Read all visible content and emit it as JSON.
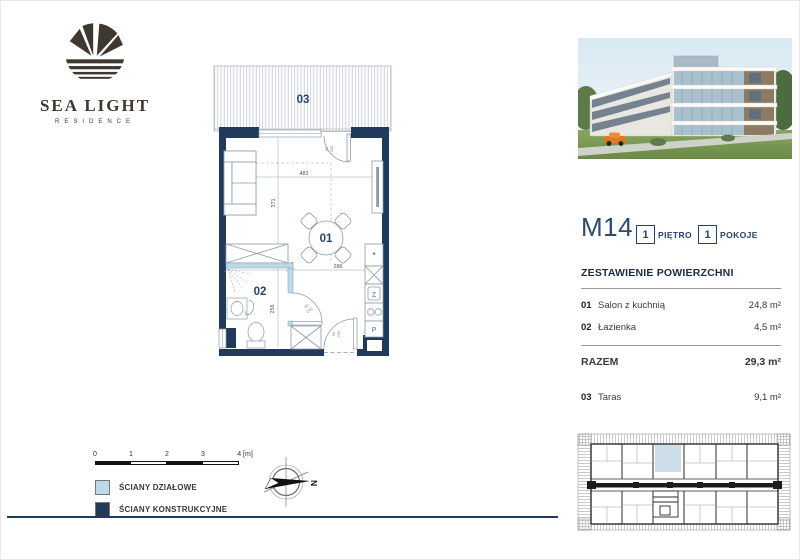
{
  "brand": {
    "name": "SEA LIGHT",
    "tagline": "RESIDENCE"
  },
  "unit": {
    "code": "M14",
    "floor": {
      "value": "1",
      "label": "PIĘTRO"
    },
    "rooms": {
      "value": "1",
      "label": "POKOJE"
    }
  },
  "areas": {
    "title": "ZESTAWIENIE POWIERZCHNI",
    "rows": [
      {
        "no": "01",
        "name": "Salon z kuchnią",
        "value": "24,8 m²"
      },
      {
        "no": "02",
        "name": "Łazienka",
        "value": "4,5 m²"
      }
    ],
    "total": {
      "label": "RAZEM",
      "value": "29,3 m²"
    },
    "extra": {
      "no": "03",
      "name": "Taras",
      "value": "9,1 m²"
    }
  },
  "plan": {
    "rooms": {
      "living": "01",
      "bath": "02",
      "terrace": "03"
    },
    "dims": {
      "living_w": "482",
      "living_h": "371",
      "bath_w": "188",
      "wall": "8",
      "kitchen_w": "286",
      "bath_h": "256"
    },
    "doors": {
      "terrace": [
        "90",
        "230"
      ],
      "bath": [
        "80",
        "200"
      ],
      "entry": [
        "90",
        "200"
      ]
    },
    "kitchen": {
      "sink": "Z",
      "washer": "P",
      "star": "*"
    }
  },
  "legend": {
    "scale": {
      "ticks": [
        "0",
        "1",
        "2",
        "3",
        "4 [m]"
      ]
    },
    "items": [
      {
        "label": "ŚCIANY DZIAŁOWE",
        "color": "#bcd9e6"
      },
      {
        "label": "ŚCIANY KONSTRUKCYJNE",
        "color": "#21395a"
      }
    ],
    "compass": "N"
  },
  "colors": {
    "walls": "#21395a",
    "partitions": "#bcd9e6",
    "plan_lines": "#8c9aa6"
  }
}
